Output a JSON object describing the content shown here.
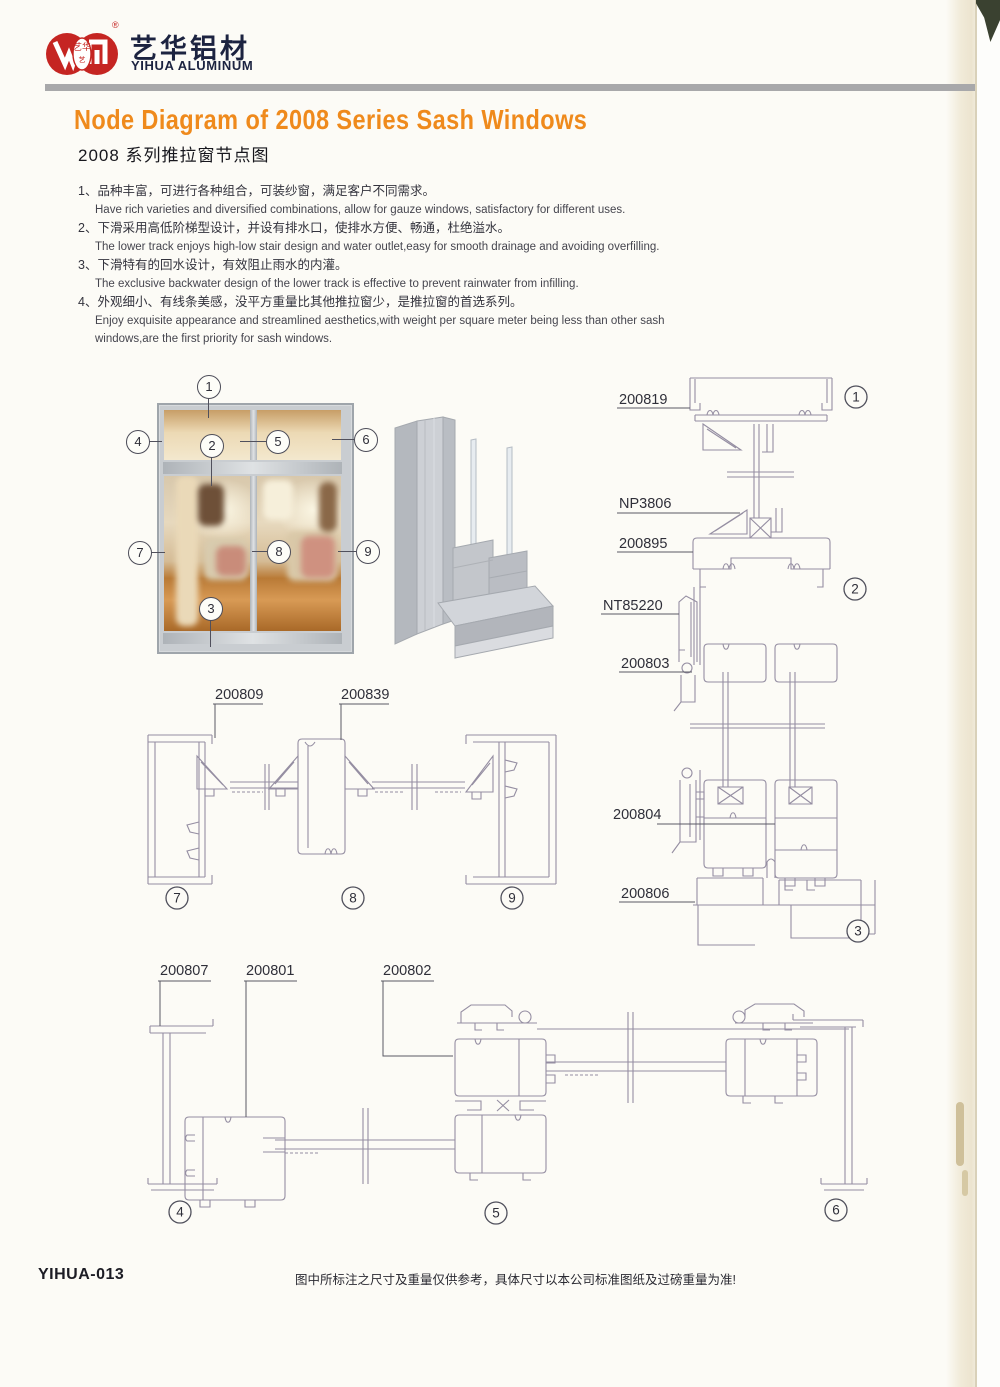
{
  "brand": {
    "logo_cn": "艺华铝材",
    "logo_en": "YIHUA ALUMINUM",
    "reg_mark": "®",
    "seal_text": "艺华"
  },
  "header": {
    "title_en": "Node Diagram of 2008 Series Sash Windows",
    "title_cn": "2008 系列推拉窗节点图"
  },
  "features": [
    {
      "cn": "1、品种丰富，可进行各种组合，可装纱窗，满足客户不同需求。",
      "en": "Have rich varieties and diversified combinations, allow for gauze windows, satisfactory for different uses."
    },
    {
      "cn": "2、下滑采用高低阶梯型设计，并设有排水口，使排水方便、畅通，杜绝溢水。",
      "en": "The lower track enjoys high-low stair design and water outlet,easy for smooth drainage and avoiding overfilling."
    },
    {
      "cn": "3、下滑特有的回水设计，有效阻止雨水的内灌。",
      "en": "The exclusive backwater design of the lower track is effective to prevent rainwater from infilling."
    },
    {
      "cn": "4、外观细小、有线条美感，没平方重量比其他推拉窗少，是推拉窗的首选系列。",
      "en": "Enjoy exquisite appearance and streamlined aesthetics,with weight per square meter being less than other sash windows,are the first priority for sash windows."
    }
  ],
  "callouts": {
    "c1": "1",
    "c2": "2",
    "c3": "3",
    "c4": "4",
    "c5": "5",
    "c6": "6",
    "c7": "7",
    "c8": "8",
    "c9": "9"
  },
  "parts": {
    "p200819": "200819",
    "pNP3806": "NP3806",
    "p200895": "200895",
    "pNT85220": "NT85220",
    "p200803": "200803",
    "p200804": "200804",
    "p200806": "200806",
    "p200809": "200809",
    "p200839": "200839",
    "p200807": "200807",
    "p200801": "200801",
    "p200802": "200802"
  },
  "footer": {
    "code": "YIHUA-013",
    "note": "图中所标注之尺寸及重量仅供参考，具体尺寸以本公司标准图纸及过磅重量为准!"
  },
  "colors": {
    "accent_orange": "#ef8a1c",
    "brand_red": "#c52522",
    "brand_navy": "#1c2340",
    "rule_gray": "#a8a8aa",
    "drawing_line": "#958ea2"
  }
}
